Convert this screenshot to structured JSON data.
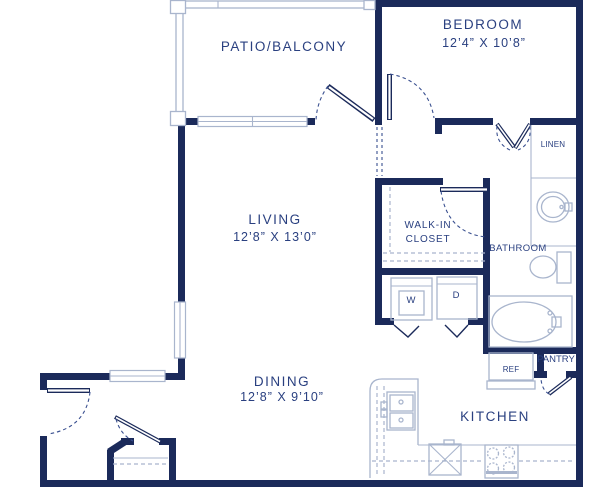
{
  "plan": {
    "labels": {
      "patio": "PATIO/BALCONY",
      "bedroom": "BEDROOM",
      "bedroom_dims": "12’4” X 10’8”",
      "living": "LIVING",
      "living_dims": "12’8” X 13’0”",
      "walk_in_1": "WALK-IN",
      "walk_in_2": "CLOSET",
      "bathroom": "BATHROOM",
      "linen": "LINEN",
      "washer": "W",
      "dryer": "D",
      "dining": "DINING",
      "dining_dims": "12’8” X 9’10”",
      "kitchen": "KITCHEN",
      "ref": "REF",
      "pantry": "PANTRY"
    },
    "colors": {
      "wall": "#1b2a5a",
      "fixture_line": "#a9b5cd",
      "label_text": "#2a4080",
      "door_arc": "#3a5090",
      "background": "#ffffff"
    }
  }
}
